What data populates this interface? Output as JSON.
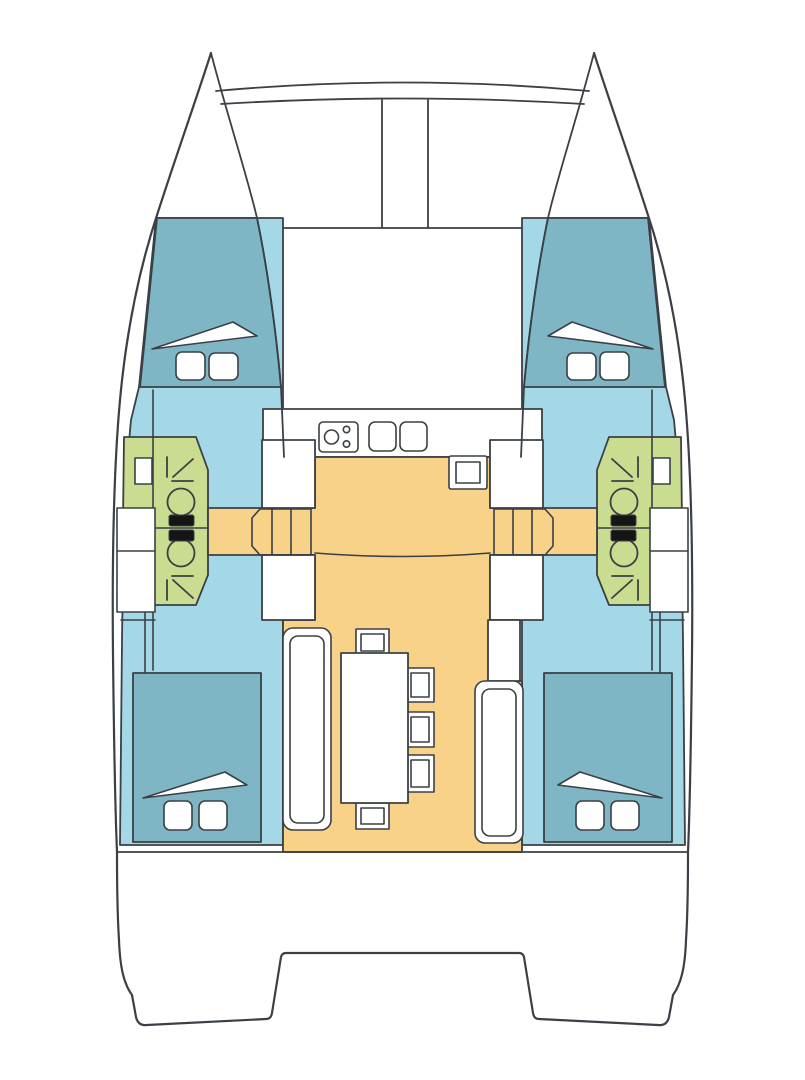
{
  "plan": {
    "vessel_type": "catamaran",
    "view": "deck-plan-top-view"
  },
  "colors": {
    "line": "#3a4045",
    "white": "#ffffff",
    "hull_interior": "#a5d8e7",
    "cabin_bed": "#7fb6c5",
    "head_compartment": "#c9dc8f",
    "salon_floor": "#f8d289",
    "toilet_tank": "#151515"
  }
}
